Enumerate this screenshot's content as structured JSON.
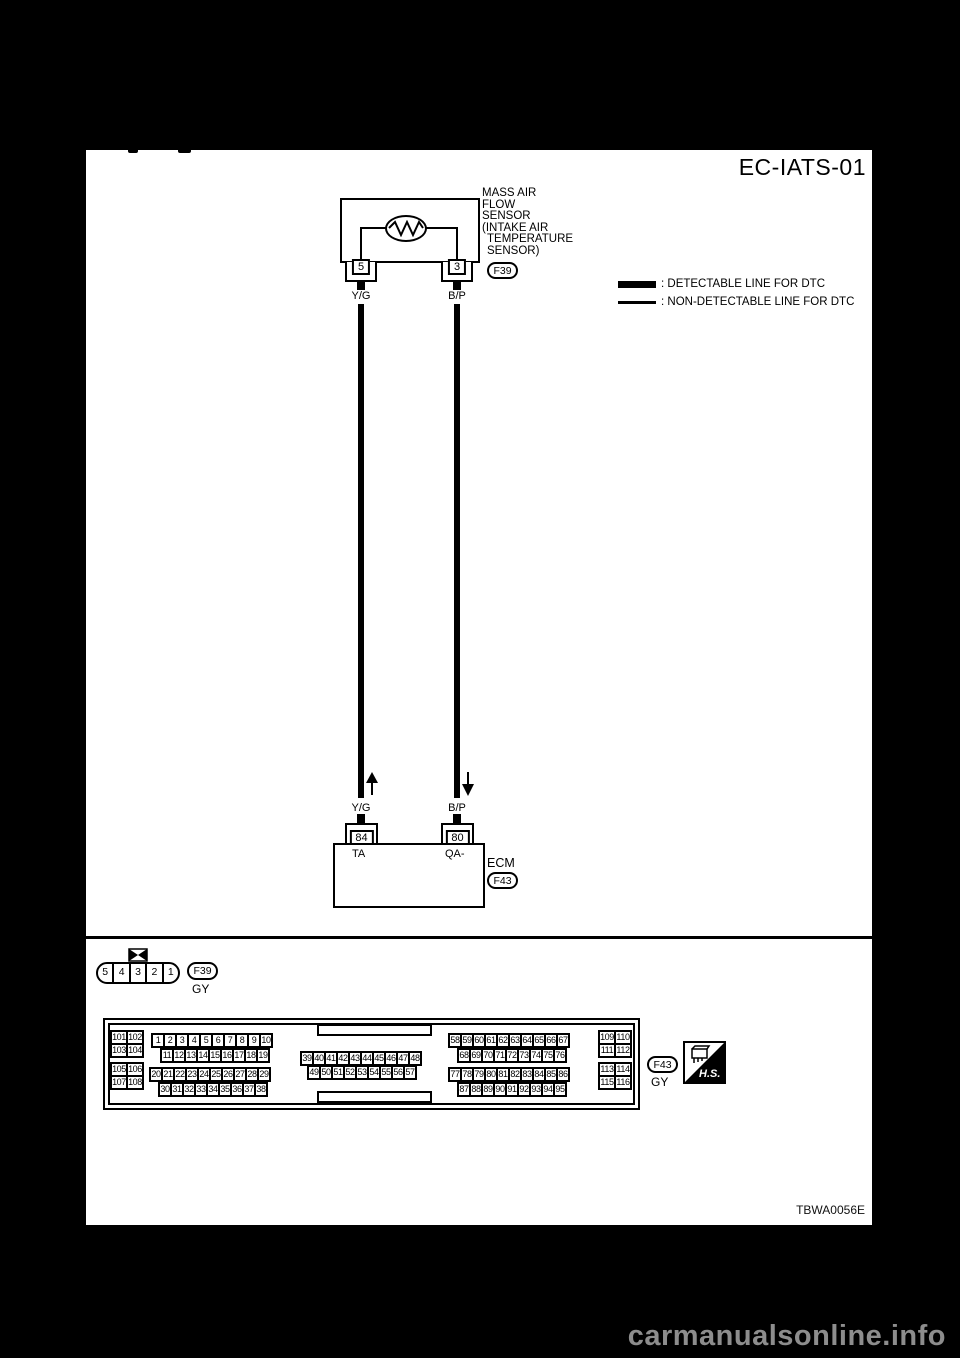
{
  "page": {
    "title": "EC-IATS-01",
    "figure_code": "TBWA0056E",
    "watermark": "carmanualsonline.info",
    "colors": {
      "page_bg": "#000000",
      "sheet_bg": "#ffffff",
      "line": "#000000",
      "watermark": "#8d8d8d"
    }
  },
  "legend": {
    "detectable_label": ": DETECTABLE LINE FOR DTC",
    "non_detectable_label": ": NON-DETECTABLE LINE FOR DTC"
  },
  "sensor": {
    "label_lines": [
      "MASS AIR",
      "FLOW",
      "SENSOR",
      "(INTAKE AIR",
      "TEMPERATURE",
      "SENSOR)"
    ],
    "connector_id": "F39",
    "pins": [
      {
        "number": "5",
        "wire": "Y/G"
      },
      {
        "number": "3",
        "wire": "B/P"
      }
    ]
  },
  "ecm": {
    "label": "ECM",
    "connector_id": "F43",
    "pins": [
      {
        "number": "84",
        "terminal": "TA",
        "wire": "Y/G",
        "arrow": "up"
      },
      {
        "number": "80",
        "terminal": "QA-",
        "wire": "B/P",
        "arrow": "down"
      }
    ]
  },
  "connector_f39": {
    "id": "F39",
    "color": "GY",
    "cells": [
      "5",
      "4",
      "3",
      "2",
      "1"
    ]
  },
  "connector_f43": {
    "id": "F43",
    "color": "GY",
    "hs_label": "H.S.",
    "left_grid": [
      [
        "101",
        "102"
      ],
      [
        "103",
        "104"
      ],
      [
        "105",
        "106"
      ],
      [
        "107",
        "108"
      ]
    ],
    "right_grid": [
      [
        "109",
        "110"
      ],
      [
        "111",
        "112"
      ],
      [
        "113",
        "114"
      ],
      [
        "115",
        "116"
      ]
    ],
    "rows": {
      "r1": [
        "1",
        "2",
        "3",
        "4",
        "5",
        "6",
        "7",
        "8",
        "9",
        "10"
      ],
      "r2": [
        "11",
        "12",
        "13",
        "14",
        "15",
        "16",
        "17",
        "18",
        "19"
      ],
      "r3": [
        "20",
        "21",
        "22",
        "23",
        "24",
        "25",
        "26",
        "27",
        "28",
        "29"
      ],
      "r4": [
        "30",
        "31",
        "32",
        "33",
        "34",
        "35",
        "36",
        "37",
        "38"
      ],
      "c1": [
        "39",
        "40",
        "41",
        "42",
        "43",
        "44",
        "45",
        "46",
        "47",
        "48"
      ],
      "c2": [
        "49",
        "50",
        "51",
        "52",
        "53",
        "54",
        "55",
        "56",
        "57"
      ],
      "m1": [
        "58",
        "59",
        "60",
        "61",
        "62",
        "63",
        "64",
        "65",
        "66",
        "67"
      ],
      "m2": [
        "68",
        "69",
        "70",
        "71",
        "72",
        "73",
        "74",
        "75",
        "76"
      ],
      "m3": [
        "77",
        "78",
        "79",
        "80",
        "81",
        "82",
        "83",
        "84",
        "85",
        "86"
      ],
      "m4": [
        "87",
        "88",
        "89",
        "90",
        "91",
        "92",
        "93",
        "94",
        "95"
      ]
    }
  }
}
